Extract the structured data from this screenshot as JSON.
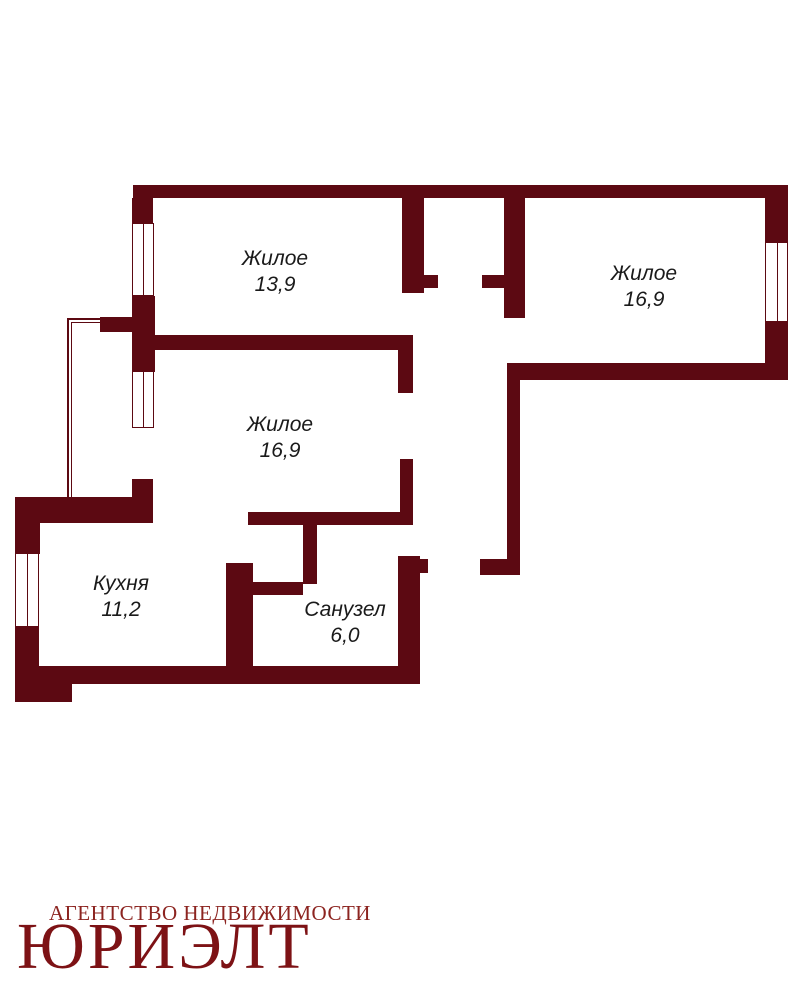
{
  "floorplan": {
    "wall_color": "#5C0912",
    "label_color": "#1a1a1a",
    "rooms": [
      {
        "name": "Жилое",
        "area": "13,9"
      },
      {
        "name": "Жилое",
        "area": "16,9"
      },
      {
        "name": "Жилое",
        "area": "16,9"
      },
      {
        "name": "Кухня",
        "area": "11,2"
      },
      {
        "name": "Санузел",
        "area": "6,0"
      }
    ]
  },
  "logo": {
    "agency_line": "АГЕНТСТВО НЕДВИЖИМОСТИ",
    "brand": "ЮРИЭЛТ",
    "agency_color": "#8C2420",
    "brand_color": "#7D1215"
  }
}
